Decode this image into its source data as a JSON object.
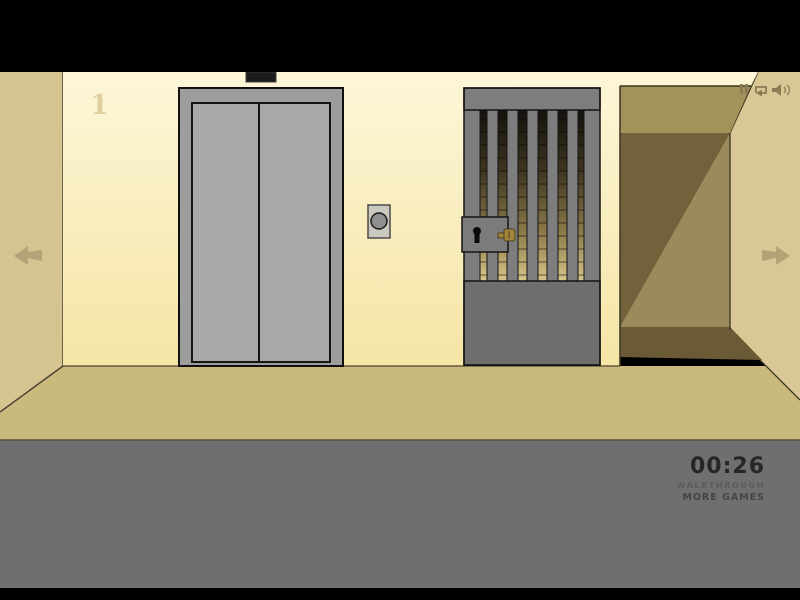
{
  "scene": {
    "room_number": "1"
  },
  "hud": {
    "timer": "00:26",
    "walkthrough_label": "WALKTHROUGH",
    "more_games_label": "MORE GAMES"
  },
  "icons": {
    "pause": "pause-bars-icon",
    "music": "music-loop-icon",
    "sound": "speaker-icon",
    "nav_left": "left-arrow-icon",
    "nav_right": "right-arrow-icon"
  },
  "colors": {
    "letterbox_black": "#000000",
    "front_wall_top": "#fdf6d8",
    "front_wall_bottom": "#f5e5a5",
    "left_wall": "#d5c390",
    "right_wall": "#d9c795",
    "floor": "#cab97c",
    "foreground_floor": "#6f6f6f",
    "elevator_frame": "#9d9d9d",
    "elevator_door": "#a8a8a8",
    "elevator_indicator": "#1c1c1c",
    "button_plate": "#cbc8bf",
    "button_circle": "#8f8f8f",
    "gate_frame": "#7d7d7d",
    "gate_lower_panel": "#6e6e6e",
    "corridor_ceiling": "#a39259",
    "corridor_wall_light": "#9b8a5c",
    "corridor_wall_shadow": "#71623c",
    "corridor_floor": "#6a5b36",
    "key_gold": "#a0853a",
    "arrow": "#b2a477",
    "icon_brown": "#8a7c54",
    "timer_text": "#262626",
    "room_number_text": "#dbc995"
  }
}
